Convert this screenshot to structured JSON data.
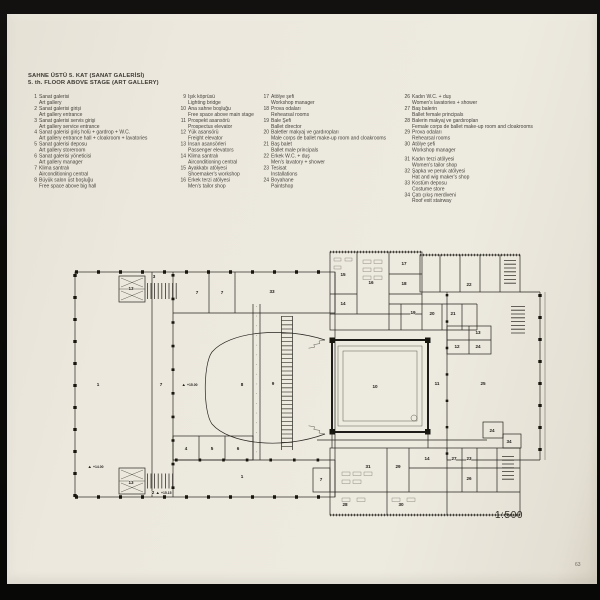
{
  "page": {
    "title_line1": "SAHNE ÜSTÜ 5. KAT (SANAT GALERİSİ)",
    "title_line2": "5. th. FLOOR ABOVE STAGE (ART GALLERY)",
    "scale_label": "1:500",
    "page_number": "63"
  },
  "colors": {
    "page_bg": "#ece8de",
    "ink": "#26241f",
    "photo_bg": "#0b0a09"
  },
  "legend": {
    "columns": [
      {
        "items": [
          {
            "no": "1",
            "tr": "Sanat galerisi",
            "en": "Art gallery"
          },
          {
            "no": "2",
            "tr": "Sanat galerisi girişi",
            "en": "Art gallery entrance"
          },
          {
            "no": "3",
            "tr": "Sanat galerisi servis girişi",
            "en": "Art gallery service entrance"
          },
          {
            "no": "4",
            "tr": "Sanat galerisi giriş holü + gardrop + W.C.",
            "en": "Art gallery entrance hall + cloakroom + lavatories"
          },
          {
            "no": "5",
            "tr": "Sanat galerisi deposu",
            "en": "Art gallery storeroom"
          },
          {
            "no": "6",
            "tr": "Sanat galerisi yöneticisi",
            "en": "Art gallery manager"
          },
          {
            "no": "7",
            "tr": "Klima santralı",
            "en": "Airconditioning central"
          },
          {
            "no": "8",
            "tr": "Büyük salon üst boşluğu",
            "en": "Free space above big hall"
          }
        ]
      },
      {
        "items": [
          {
            "no": "9",
            "tr": "Işık köprüsü",
            "en": "Lighting bridge"
          },
          {
            "no": "10",
            "tr": "Ana sahne boşluğu",
            "en": "Free space above main stage"
          },
          {
            "no": "11",
            "tr": "Prospekt asansörü",
            "en": "Prospectus elevator"
          },
          {
            "no": "12",
            "tr": "Yük asansörü",
            "en": "Freight elevator"
          },
          {
            "no": "13",
            "tr": "İnsan asansörleri",
            "en": "Passenger elevators"
          },
          {
            "no": "14",
            "tr": "Klima santralı",
            "en": "Airconditioning central"
          },
          {
            "no": "15",
            "tr": "Ayakkabı atölyesi",
            "en": "Shoemaker's workshop"
          },
          {
            "no": "16",
            "tr": "Erkek terzi atölyesi",
            "en": "Men's tailor shop"
          }
        ]
      },
      {
        "items": [
          {
            "no": "17",
            "tr": "Atölye şefi",
            "en": "Workshop manager"
          },
          {
            "no": "18",
            "tr": "Prova odaları",
            "en": "Rehearsal rooms"
          },
          {
            "no": "19",
            "tr": "Bale Şefi",
            "en": "Ballet director"
          },
          {
            "no": "20",
            "tr": "Baletler makyaj ve gardıropları",
            "en": "Male corps de ballet make-up room and cloakrooms"
          },
          {
            "no": "21",
            "tr": "Baş balet",
            "en": "Ballet male principals"
          },
          {
            "no": "22",
            "tr": "Erkek W.C. + duş",
            "en": "Men's lavatory + shower"
          },
          {
            "no": "23",
            "tr": "Tesisat",
            "en": "Installations"
          },
          {
            "no": "24",
            "tr": "Boyahane",
            "en": "Paintshop"
          }
        ]
      },
      {
        "items": [
          {
            "no": "26",
            "tr": "Kadın W.C. + duş",
            "en": "Women's lavatories + shower"
          },
          {
            "no": "27",
            "tr": "Baş balerin",
            "en": "Ballet female principals"
          },
          {
            "no": "28",
            "tr": "Balerin makyaj ve gardıropları",
            "en": "Female corps de ballet make-up room and cloakrooms"
          },
          {
            "no": "29",
            "tr": "Prova odaları",
            "en": "Rehearsal rooms"
          },
          {
            "no": "30",
            "tr": "Atölye şefi",
            "en": "Workshop manager"
          },
          {
            "no": "31",
            "tr": "Kadın terzi atölyesi",
            "en": "Women's tailor shop"
          },
          {
            "no": "32",
            "tr": "Şapka ve peruk atölyesi",
            "en": "Hat and wig maker's shop"
          },
          {
            "no": "33",
            "tr": "Kostüm deposu",
            "en": "Costume store"
          },
          {
            "no": "34",
            "tr": "Çatı çıkış merdiveni",
            "en": "Roof exit stairway"
          }
        ]
      }
    ]
  },
  "plan": {
    "room_labels": [
      {
        "t": "13",
        "x": 74,
        "y": 46
      },
      {
        "t": "3",
        "x": 97,
        "y": 34
      },
      {
        "t": "7",
        "x": 140,
        "y": 50
      },
      {
        "t": "7",
        "x": 165,
        "y": 50
      },
      {
        "t": "33",
        "x": 215,
        "y": 49
      },
      {
        "t": "15",
        "x": 286,
        "y": 32
      },
      {
        "t": "16",
        "x": 314,
        "y": 40
      },
      {
        "t": "17",
        "x": 347,
        "y": 21
      },
      {
        "t": "18",
        "x": 347,
        "y": 41
      },
      {
        "t": "14",
        "x": 286,
        "y": 61
      },
      {
        "t": "19",
        "x": 356,
        "y": 70
      },
      {
        "t": "20",
        "x": 375,
        "y": 71
      },
      {
        "t": "21",
        "x": 396,
        "y": 71
      },
      {
        "t": "22",
        "x": 412,
        "y": 42
      },
      {
        "t": "1",
        "x": 41,
        "y": 142
      },
      {
        "t": "7",
        "x": 104,
        "y": 142
      },
      {
        "t": "8",
        "x": 185,
        "y": 142
      },
      {
        "t": "9",
        "x": 216,
        "y": 141
      },
      {
        "t": "10",
        "x": 318,
        "y": 144
      },
      {
        "t": "11",
        "x": 380,
        "y": 141
      },
      {
        "t": "25",
        "x": 426,
        "y": 141
      },
      {
        "t": "12",
        "x": 400,
        "y": 104
      },
      {
        "t": "13",
        "x": 421,
        "y": 90
      },
      {
        "t": "24",
        "x": 421,
        "y": 104
      },
      {
        "t": "4",
        "x": 129,
        "y": 206
      },
      {
        "t": "5",
        "x": 155,
        "y": 206
      },
      {
        "t": "6",
        "x": 181,
        "y": 206
      },
      {
        "t": "1",
        "x": 185,
        "y": 234
      },
      {
        "t": "13",
        "x": 74,
        "y": 240
      },
      {
        "t": "2",
        "x": 96,
        "y": 250
      },
      {
        "t": "7",
        "x": 264,
        "y": 237
      },
      {
        "t": "31",
        "x": 311,
        "y": 224
      },
      {
        "t": "29",
        "x": 341,
        "y": 224
      },
      {
        "t": "14",
        "x": 370,
        "y": 216
      },
      {
        "t": "27",
        "x": 397,
        "y": 216
      },
      {
        "t": "23",
        "x": 412,
        "y": 216
      },
      {
        "t": "26",
        "x": 412,
        "y": 236
      },
      {
        "t": "28",
        "x": 288,
        "y": 262
      },
      {
        "t": "30",
        "x": 344,
        "y": 262
      },
      {
        "t": "24",
        "x": 435,
        "y": 188
      },
      {
        "t": "34",
        "x": 452,
        "y": 199
      }
    ],
    "elevation_labels": [
      {
        "t": "+15.00",
        "x": 130,
        "y": 142
      },
      {
        "t": "+14.00",
        "x": 36,
        "y": 224
      },
      {
        "t": "+15.15",
        "x": 104,
        "y": 250
      }
    ]
  }
}
